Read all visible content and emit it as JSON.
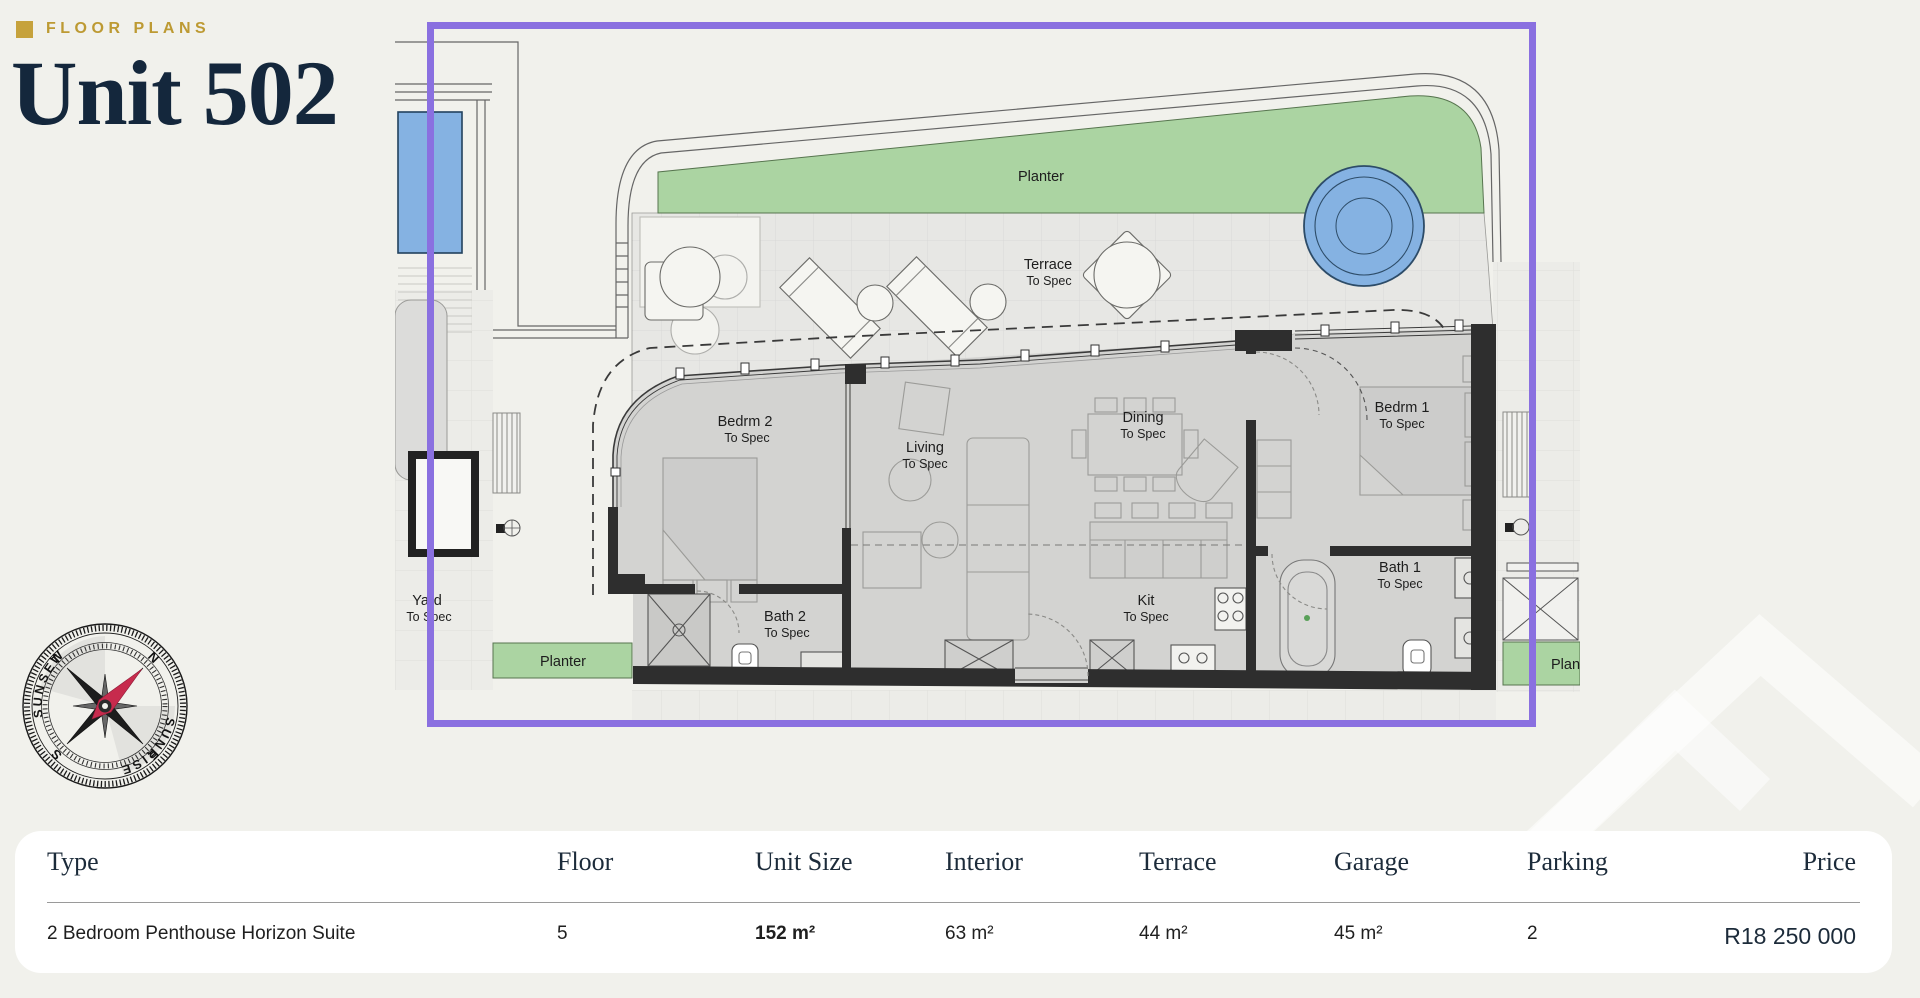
{
  "page": {
    "background": "#f1f1ec"
  },
  "header": {
    "eyebrow": "FLOOR PLANS",
    "title": "Unit 502"
  },
  "plan": {
    "highlight_color": "#8a70e0",
    "planter_color": "#abd4a2",
    "pool_color": "#85b2e2",
    "rooms": {
      "planter_top": {
        "name": "Planter"
      },
      "terrace": {
        "name": "Terrace",
        "spec": "To Spec"
      },
      "bedroom2": {
        "name": "Bedrm 2",
        "spec": "To Spec"
      },
      "living": {
        "name": "Living",
        "spec": "To Spec"
      },
      "dining": {
        "name": "Dining",
        "spec": "To Spec"
      },
      "kitchen": {
        "name": "Kit",
        "spec": "To Spec"
      },
      "bedroom1": {
        "name": "Bedrm 1",
        "spec": "To Spec"
      },
      "bath1": {
        "name": "Bath 1",
        "spec": "To Spec"
      },
      "bath2": {
        "name": "Bath 2",
        "spec": "To Spec"
      },
      "yard": {
        "name": "Yard",
        "spec": "To Spec"
      },
      "planter_left": {
        "name": "Planter"
      },
      "planter_right": {
        "name": "Planter"
      }
    }
  },
  "compass": {
    "north": "N",
    "east": "E",
    "south": "S",
    "west": "W",
    "sunset": "SUNSET",
    "sunrise": "SUNRISE"
  },
  "table": {
    "headers": {
      "type": "Type",
      "floor": "Floor",
      "unit_size": "Unit Size",
      "interior": "Interior",
      "terrace": "Terrace",
      "garage": "Garage",
      "parking": "Parking",
      "price": "Price"
    },
    "row": {
      "type": "2 Bedroom Penthouse Horizon Suite",
      "floor": "5",
      "unit_size": "152 m²",
      "interior": "63 m²",
      "terrace": "44 m²",
      "garage": "45 m²",
      "parking": "2",
      "price": "R18 250 000"
    }
  }
}
